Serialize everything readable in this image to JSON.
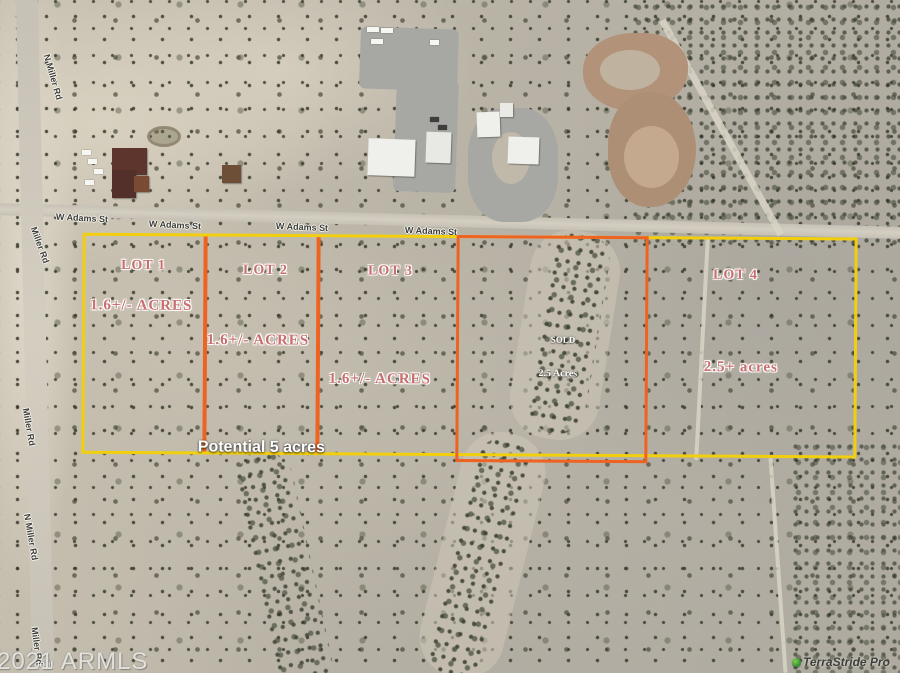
{
  "streets": {
    "w_adams": "W Adams St",
    "n_miller": "N Miller Rd",
    "miller": "Miller Rd"
  },
  "lots": [
    {
      "name": "LOT 1",
      "acreage": "1.6+/- ACRES"
    },
    {
      "name": "LOT 2",
      "acreage": "1.6+/- ACRES"
    },
    {
      "name": "LOT 3",
      "acreage": "1.6+/- ACRES"
    },
    {
      "name": "SOLD",
      "acreage": "2.5 Acres"
    },
    {
      "name": "LOT 4",
      "acreage": "2.5+ acres"
    }
  ],
  "annotations": {
    "potential": "Potential 5 acres"
  },
  "watermarks": {
    "armls": "2021 ARMLS",
    "google_fragment": "oogl",
    "provider": "TerraStride Pro"
  },
  "colors": {
    "parcel_outline_yellow": "#f2cf0e",
    "lot_divider_orange": "#ee6322",
    "lot_label_pink": "#c96e6e",
    "sold_label_white": "#ffffff"
  }
}
